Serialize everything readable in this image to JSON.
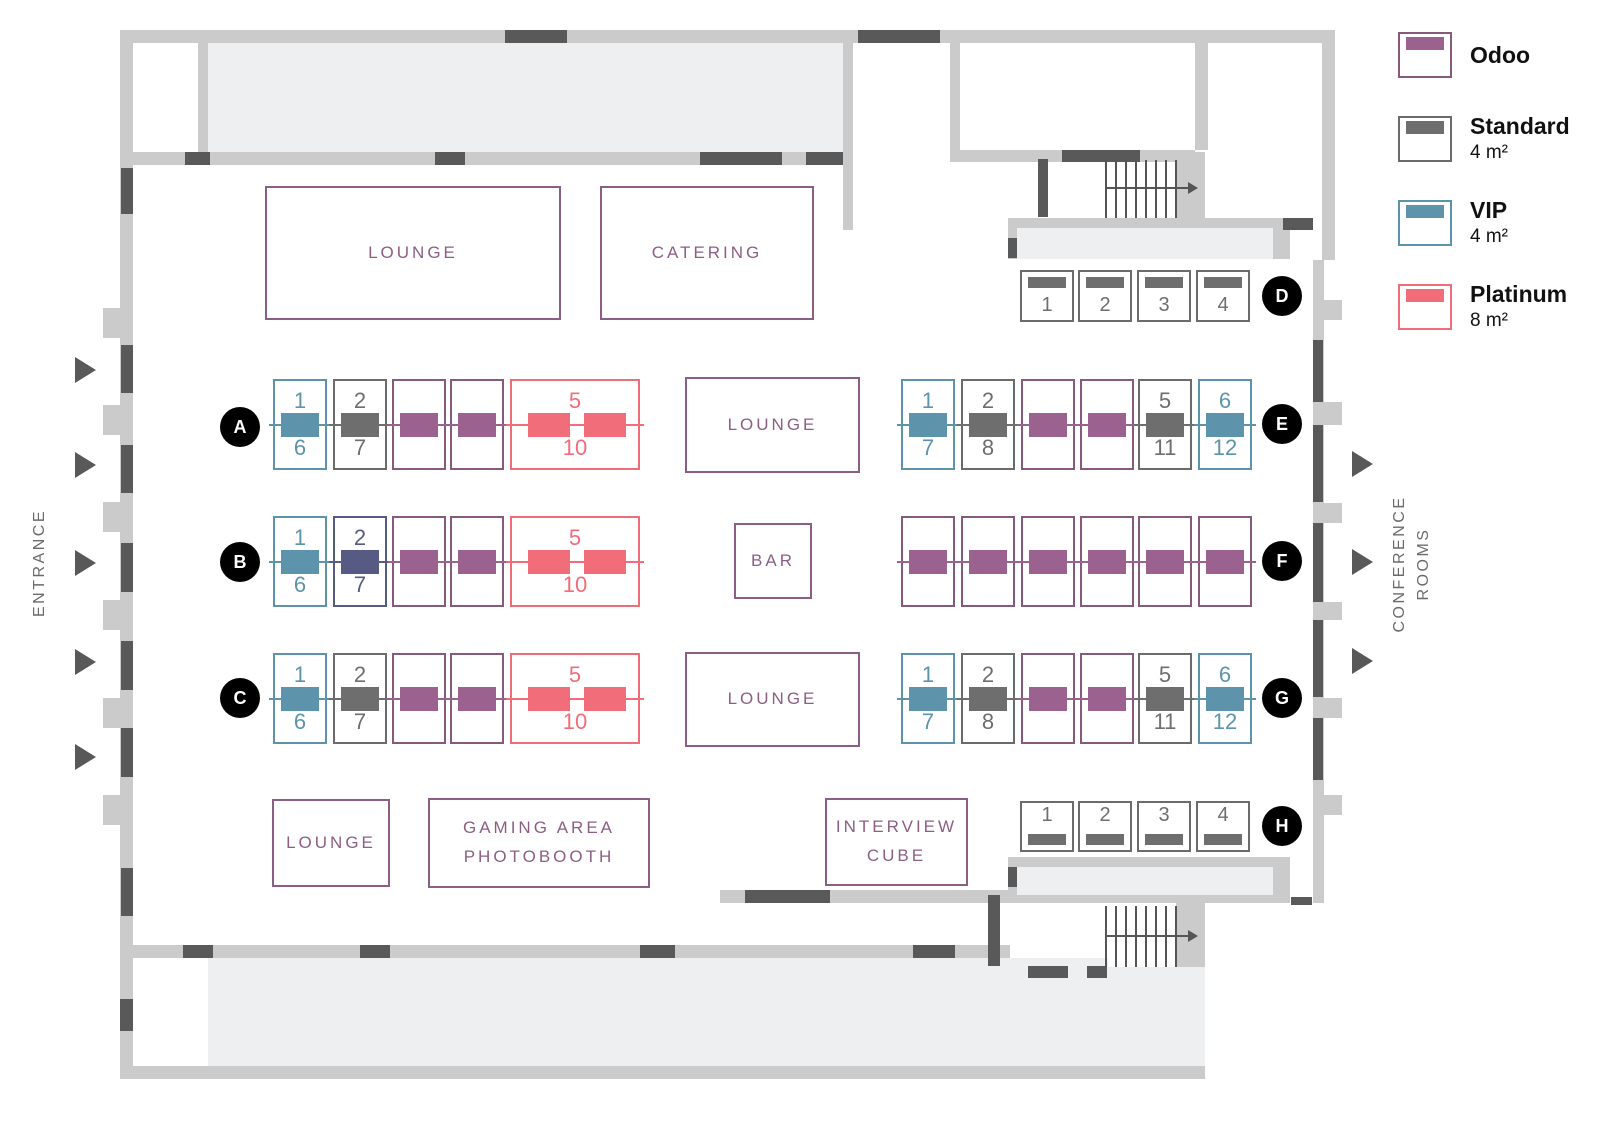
{
  "legend": {
    "items": [
      {
        "name": "Odoo",
        "size": ""
      },
      {
        "name": "Standard",
        "size": "4 m²"
      },
      {
        "name": "VIP",
        "size": "4 m²"
      },
      {
        "name": "Platinum",
        "size": "8 m²"
      }
    ]
  },
  "side_labels": {
    "entrance": "ENTRANCE",
    "conference_rooms": "CONFERENCE\nROOMS"
  },
  "areas": [
    {
      "id": "lounge-top",
      "label": "LOUNGE"
    },
    {
      "id": "catering",
      "label": "CATERING"
    },
    {
      "id": "lounge-middle",
      "label": "LOUNGE"
    },
    {
      "id": "bar",
      "label": "BAR"
    },
    {
      "id": "lounge-lower",
      "label": "LOUNGE"
    },
    {
      "id": "lounge-bottom-left",
      "label": "LOUNGE"
    },
    {
      "id": "gaming-photobooth",
      "label": "GAMING AREA\nPHOTOBOOTH"
    },
    {
      "id": "interview-cube",
      "label": "INTERVIEW\nCUBE"
    }
  ],
  "booth_types": {
    "odoo": {
      "color": "#9b618f",
      "border": "#875a7b"
    },
    "standard": {
      "color": "#6e6e6e",
      "border": "#6b6b6b"
    },
    "vip": {
      "color": "#5d93ab",
      "border": "#5d93ab"
    },
    "platinum": {
      "color": "#f06d79",
      "border": "#ef6d79"
    },
    "sold": {
      "color": "#575b84",
      "border": "#575b84"
    }
  },
  "rows": [
    {
      "id": "A",
      "booths": [
        {
          "type": "vip",
          "top": "1",
          "bottom": "6"
        },
        {
          "type": "standard",
          "top": "2",
          "bottom": "7"
        },
        {
          "type": "odoo"
        },
        {
          "type": "odoo"
        },
        {
          "type": "platinum",
          "top": "5",
          "bottom": "10"
        }
      ]
    },
    {
      "id": "B",
      "booths": [
        {
          "type": "vip",
          "top": "1",
          "bottom": "6"
        },
        {
          "type": "sold",
          "top": "2",
          "bottom": "7"
        },
        {
          "type": "odoo"
        },
        {
          "type": "odoo"
        },
        {
          "type": "platinum",
          "top": "5",
          "bottom": "10"
        }
      ]
    },
    {
      "id": "C",
      "booths": [
        {
          "type": "vip",
          "top": "1",
          "bottom": "6"
        },
        {
          "type": "standard",
          "top": "2",
          "bottom": "7"
        },
        {
          "type": "odoo"
        },
        {
          "type": "odoo"
        },
        {
          "type": "platinum",
          "top": "5",
          "bottom": "10"
        }
      ]
    },
    {
      "id": "D",
      "booths": [
        {
          "type": "standard",
          "num": "1"
        },
        {
          "type": "standard",
          "num": "2"
        },
        {
          "type": "standard",
          "num": "3"
        },
        {
          "type": "standard",
          "num": "4"
        }
      ]
    },
    {
      "id": "E",
      "booths": [
        {
          "type": "vip",
          "top": "1",
          "bottom": "7"
        },
        {
          "type": "standard",
          "top": "2",
          "bottom": "8"
        },
        {
          "type": "odoo"
        },
        {
          "type": "odoo"
        },
        {
          "type": "standard",
          "top": "5",
          "bottom": "11"
        },
        {
          "type": "vip",
          "top": "6",
          "bottom": "12"
        }
      ]
    },
    {
      "id": "F",
      "booths": [
        {
          "type": "odoo"
        },
        {
          "type": "odoo"
        },
        {
          "type": "odoo"
        },
        {
          "type": "odoo"
        },
        {
          "type": "odoo"
        },
        {
          "type": "odoo"
        }
      ]
    },
    {
      "id": "G",
      "booths": [
        {
          "type": "vip",
          "top": "1",
          "bottom": "7"
        },
        {
          "type": "standard",
          "top": "2",
          "bottom": "8"
        },
        {
          "type": "odoo"
        },
        {
          "type": "odoo"
        },
        {
          "type": "standard",
          "top": "5",
          "bottom": "11"
        },
        {
          "type": "vip",
          "top": "6",
          "bottom": "12"
        }
      ]
    },
    {
      "id": "H",
      "booths": [
        {
          "type": "standard",
          "num": "1"
        },
        {
          "type": "standard",
          "num": "2"
        },
        {
          "type": "standard",
          "num": "3"
        },
        {
          "type": "standard",
          "num": "4"
        }
      ]
    }
  ]
}
